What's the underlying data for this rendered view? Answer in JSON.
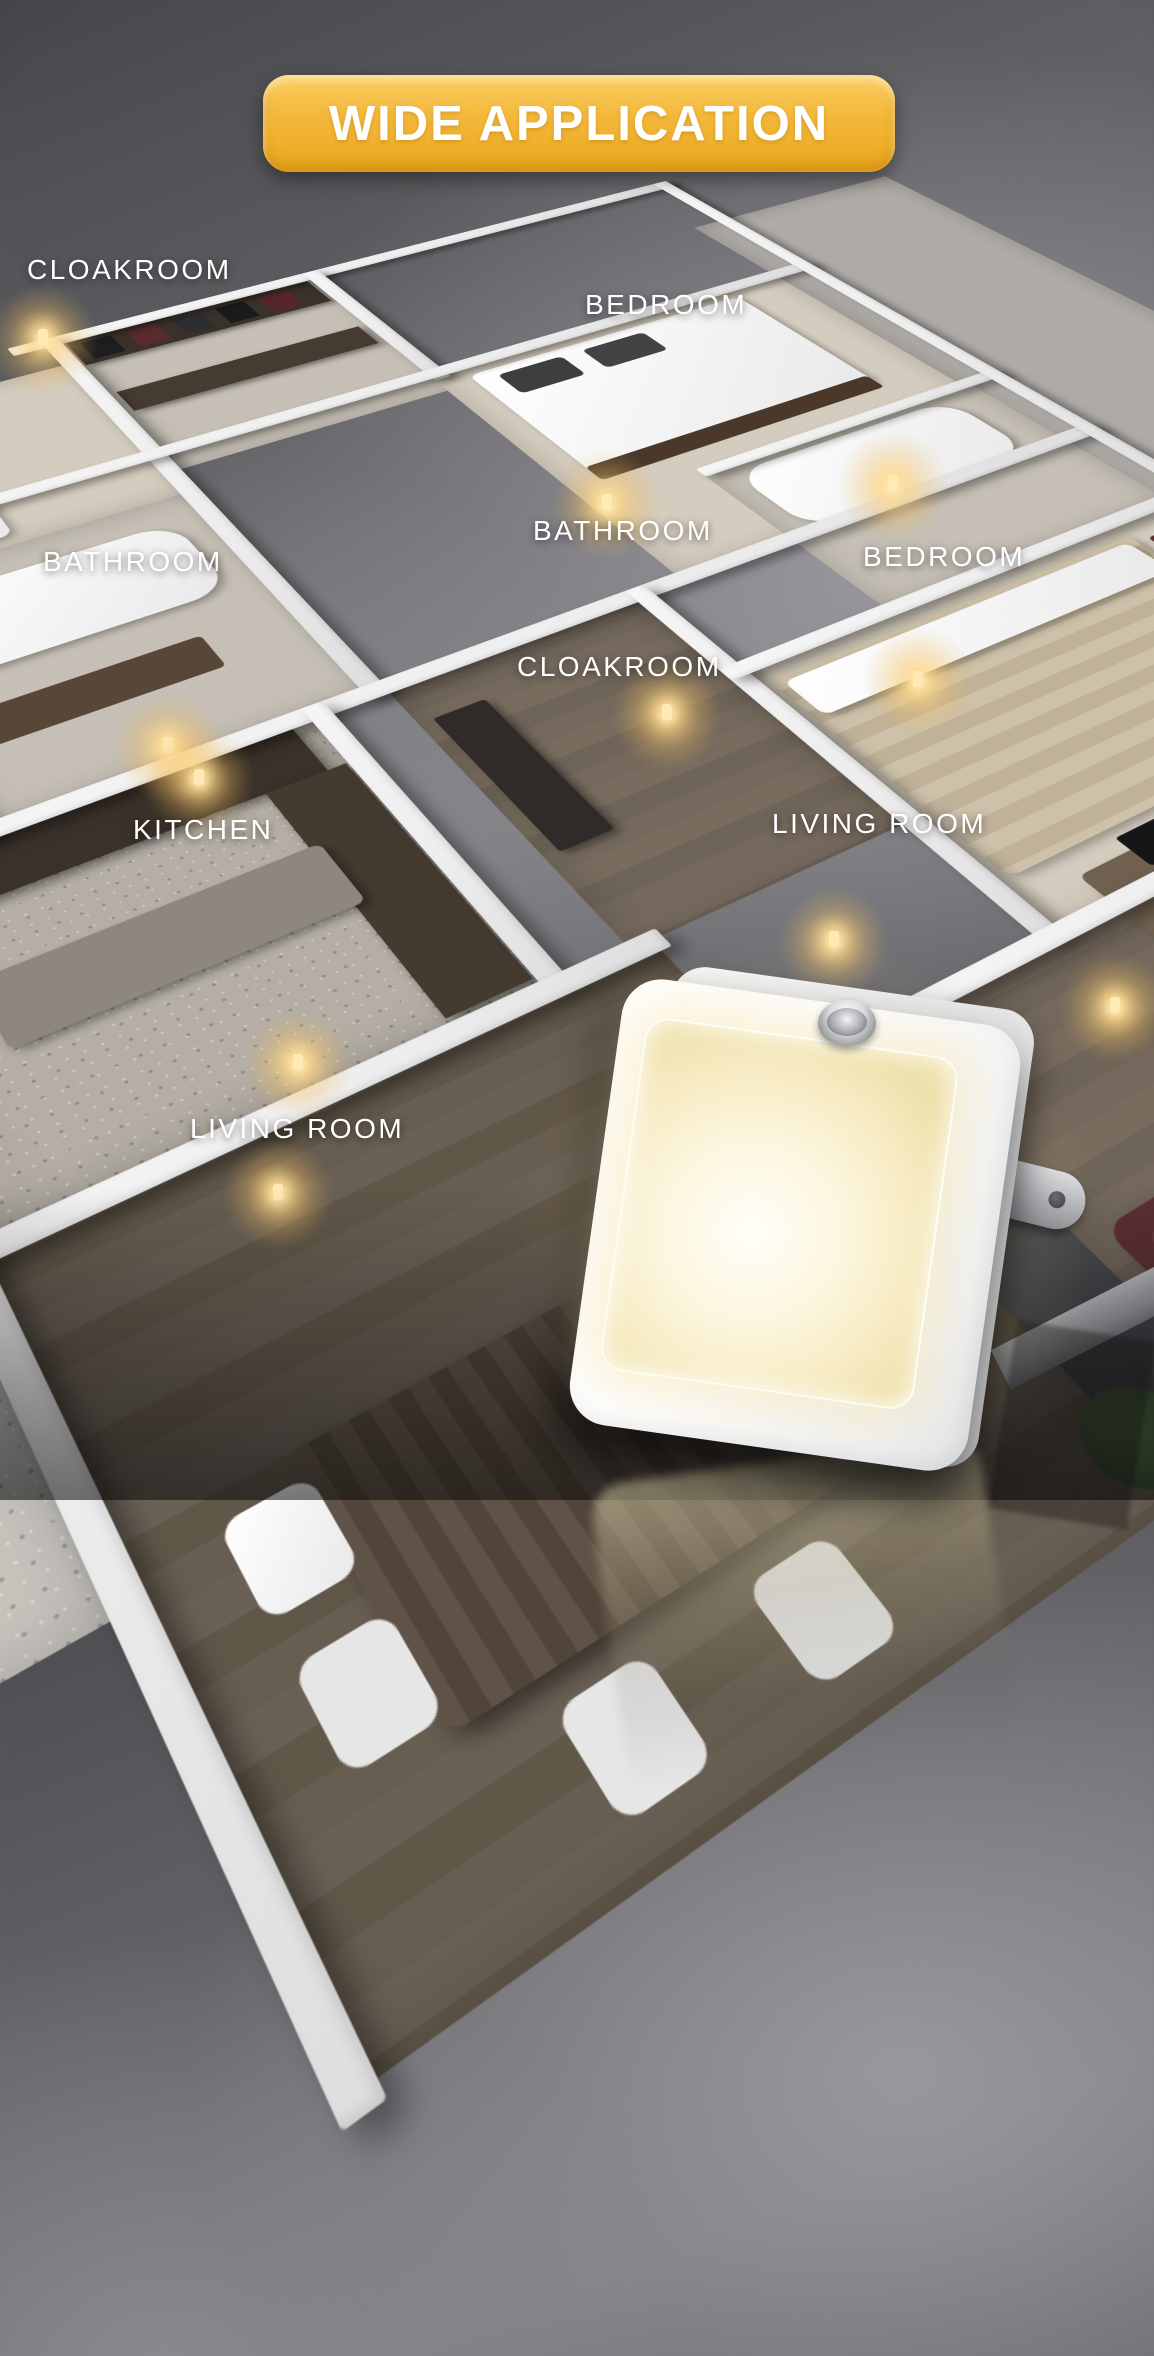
{
  "banner": {
    "label": "WIDE APPLICATION",
    "bg_gradient_top": "#f9cd62",
    "bg_gradient_bottom": "#eba81f",
    "text_color": "#ffffff"
  },
  "room_labels": [
    {
      "text": "CLOAKROOM",
      "x": 27,
      "y": 254
    },
    {
      "text": "BEDROOM",
      "x": 585,
      "y": 289
    },
    {
      "text": "BATHROOM",
      "x": 533,
      "y": 515
    },
    {
      "text": "BATHROOM",
      "x": 43,
      "y": 546
    },
    {
      "text": "BEDROOM",
      "x": 863,
      "y": 541
    },
    {
      "text": "CLOAKROOM",
      "x": 517,
      "y": 651
    },
    {
      "text": "KITCHEN",
      "x": 133,
      "y": 814
    },
    {
      "text": "LIVING ROOM",
      "x": 772,
      "y": 808
    },
    {
      "text": "LIVING ROOM",
      "x": 190,
      "y": 1113
    }
  ],
  "scene": {
    "description": "isometric 3D apartment floor plan at night with warm plug-in night lights glowing along the walls, viewed on a gray glossy backdrop",
    "background_color": "#6e6e72",
    "wall_color": "#f2f2f3",
    "wood_floor_color": "#6f655a",
    "carpet_color": "#d4ccbe",
    "glow_color": "#f5c97e",
    "glows": [
      [
        43,
        340
      ],
      [
        607,
        505
      ],
      [
        893,
        486
      ],
      [
        168,
        748
      ],
      [
        199,
        780
      ],
      [
        298,
        1065
      ],
      [
        918,
        682
      ],
      [
        834,
        942
      ],
      [
        667,
        715
      ],
      [
        1115,
        1008
      ],
      [
        278,
        1195
      ]
    ]
  },
  "product": {
    "name": "plug-in LED night light",
    "body_color": "#ffffff",
    "panel_glow_color": "#fdf6dd",
    "knob": "brightness dial",
    "plug": "US plug prong",
    "state": "glowing warm white"
  }
}
